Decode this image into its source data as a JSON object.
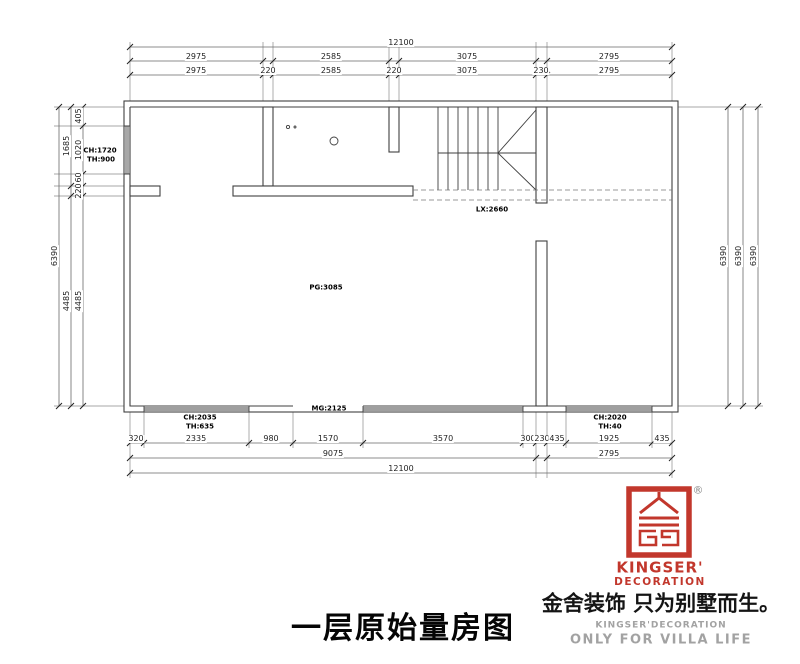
{
  "document": {
    "type": "floor-plan-survey-drawing",
    "title": "一层原始量房图"
  },
  "colors": {
    "brand_red": "#c2372c",
    "line_dark": "#3f3f3f",
    "dim_line": "#6a6a6a",
    "gray_text": "#a2a2a2",
    "text": "#000000"
  },
  "footer": {
    "title": "一层原始量房图",
    "logo_en1": "KINGSER'",
    "logo_en2": "DECORATION",
    "registered": "®",
    "slogan": "金舍装饰 只为别墅而生。",
    "sub1": "KINGSER'DECORATION",
    "sub2": "ONLY FOR VILLA LIFE"
  },
  "dim_labels": [
    {
      "t": "12100",
      "x": 401,
      "y": 43
    },
    {
      "t": "2975",
      "x": 196,
      "y": 57
    },
    {
      "t": "2585",
      "x": 331,
      "y": 57
    },
    {
      "t": "3075",
      "x": 467,
      "y": 57
    },
    {
      "t": "2795",
      "x": 609,
      "y": 57
    },
    {
      "t": "2975",
      "x": 196,
      "y": 71
    },
    {
      "t": "220",
      "x": 268,
      "y": 71
    },
    {
      "t": "2585",
      "x": 331,
      "y": 71
    },
    {
      "t": "220",
      "x": 394,
      "y": 71
    },
    {
      "t": "3075",
      "x": 467,
      "y": 71
    },
    {
      "t": "230",
      "x": 541,
      "y": 71
    },
    {
      "t": "2795",
      "x": 609,
      "y": 71
    },
    {
      "t": "320",
      "x": 136,
      "y": 439
    },
    {
      "t": "2335",
      "x": 196,
      "y": 439
    },
    {
      "t": "980",
      "x": 271,
      "y": 439
    },
    {
      "t": "1570",
      "x": 328,
      "y": 439
    },
    {
      "t": "3570",
      "x": 443,
      "y": 439
    },
    {
      "t": "300",
      "x": 528,
      "y": 439
    },
    {
      "t": "230",
      "x": 542,
      "y": 439
    },
    {
      "t": "435",
      "x": 557,
      "y": 439
    },
    {
      "t": "1925",
      "x": 609,
      "y": 439
    },
    {
      "t": "435",
      "x": 662,
      "y": 439
    },
    {
      "t": "9075",
      "x": 333,
      "y": 454
    },
    {
      "t": "2795",
      "x": 609,
      "y": 454
    },
    {
      "t": "12100",
      "x": 401,
      "y": 469
    },
    {
      "t": "405",
      "x": 79,
      "y": 116,
      "v": 1
    },
    {
      "t": "1020",
      "x": 79,
      "y": 150,
      "v": 1
    },
    {
      "t": "260",
      "x": 79,
      "y": 180,
      "v": 1
    },
    {
      "t": "220",
      "x": 79,
      "y": 191,
      "v": 1
    },
    {
      "t": "4485",
      "x": 79,
      "y": 301,
      "v": 1
    },
    {
      "t": "1685",
      "x": 67,
      "y": 146,
      "v": 1
    },
    {
      "t": "4485",
      "x": 67,
      "y": 301,
      "v": 1
    },
    {
      "t": "6390",
      "x": 55,
      "y": 256,
      "v": 1
    },
    {
      "t": "6390",
      "x": 724,
      "y": 256,
      "v": 1
    },
    {
      "t": "6390",
      "x": 739,
      "y": 256,
      "v": 1
    },
    {
      "t": "6390",
      "x": 754,
      "y": 256,
      "v": 1
    }
  ],
  "plan_labels": [
    {
      "t": "CH:1720",
      "x": 100,
      "y": 151
    },
    {
      "t": "TH:900",
      "x": 101,
      "y": 160
    },
    {
      "t": "LX:2660",
      "x": 492,
      "y": 210
    },
    {
      "t": "PG:3085",
      "x": 326,
      "y": 288
    },
    {
      "t": "MG:2125",
      "x": 329,
      "y": 409
    },
    {
      "t": "CH:2035",
      "x": 200,
      "y": 418
    },
    {
      "t": "TH:635",
      "x": 200,
      "y": 427
    },
    {
      "t": "CH:2020",
      "x": 610,
      "y": 418
    },
    {
      "t": "TH:40",
      "x": 610,
      "y": 427
    }
  ]
}
